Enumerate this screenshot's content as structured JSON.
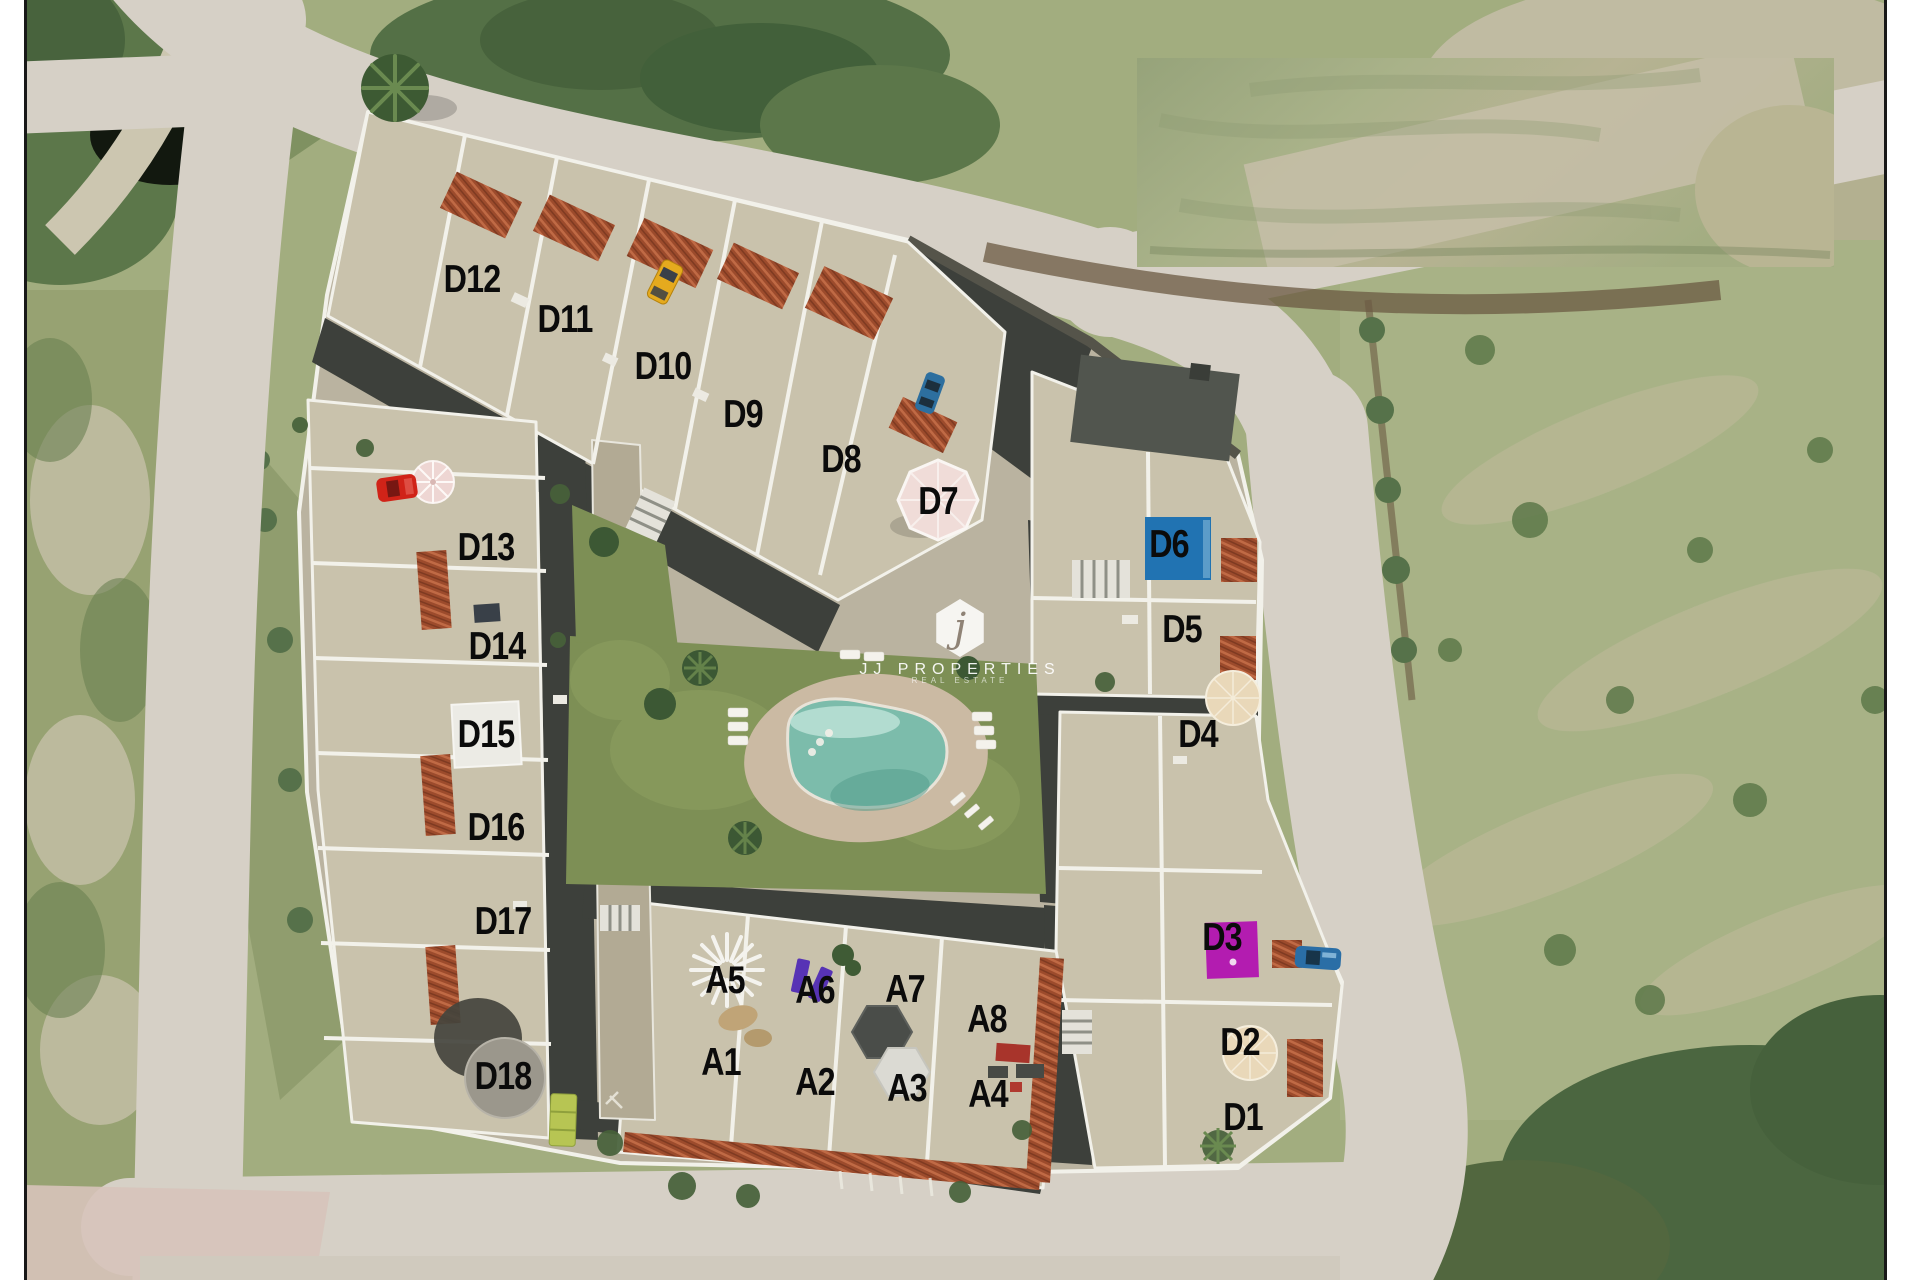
{
  "watermark": {
    "monogram": "j",
    "title": "JJ PROPERTIES",
    "subtitle": "REAL ESTATE"
  },
  "site": {
    "label_color": "#0b0b0b",
    "units": [
      {
        "id": "D12",
        "x": 472,
        "y": 280
      },
      {
        "id": "D11",
        "x": 565,
        "y": 320
      },
      {
        "id": "D10",
        "x": 663,
        "y": 367
      },
      {
        "id": "D9",
        "x": 743,
        "y": 415
      },
      {
        "id": "D8",
        "x": 841,
        "y": 460
      },
      {
        "id": "D7",
        "x": 938,
        "y": 502
      },
      {
        "id": "D6",
        "x": 1169,
        "y": 545
      },
      {
        "id": "D5",
        "x": 1182,
        "y": 630
      },
      {
        "id": "D4",
        "x": 1198,
        "y": 735
      },
      {
        "id": "D13",
        "x": 486,
        "y": 548
      },
      {
        "id": "D14",
        "x": 497,
        "y": 647
      },
      {
        "id": "D15",
        "x": 486,
        "y": 735
      },
      {
        "id": "D16",
        "x": 496,
        "y": 828
      },
      {
        "id": "D17",
        "x": 503,
        "y": 922
      },
      {
        "id": "D18",
        "x": 503,
        "y": 1077
      },
      {
        "id": "A5",
        "x": 725,
        "y": 981
      },
      {
        "id": "A6",
        "x": 815,
        "y": 991
      },
      {
        "id": "A7",
        "x": 905,
        "y": 990
      },
      {
        "id": "A8",
        "x": 987,
        "y": 1020
      },
      {
        "id": "A1",
        "x": 721,
        "y": 1063
      },
      {
        "id": "A2",
        "x": 815,
        "y": 1083
      },
      {
        "id": "A3",
        "x": 907,
        "y": 1089
      },
      {
        "id": "A4",
        "x": 988,
        "y": 1095
      },
      {
        "id": "D3",
        "x": 1222,
        "y": 938
      },
      {
        "id": "D2",
        "x": 1240,
        "y": 1043
      },
      {
        "id": "D1",
        "x": 1243,
        "y": 1118
      }
    ]
  },
  "accents": {
    "rooftop_pool_d6": "#2173b2",
    "rooftop_panel_d3": "#b31cb0",
    "terrace_square_d15": "#ecebe5",
    "round_table_d18": "#9b978c",
    "umbrella_d7": "#f0dcd8",
    "pool_water": "#7cbcab",
    "lawn": "#7d8f55"
  }
}
